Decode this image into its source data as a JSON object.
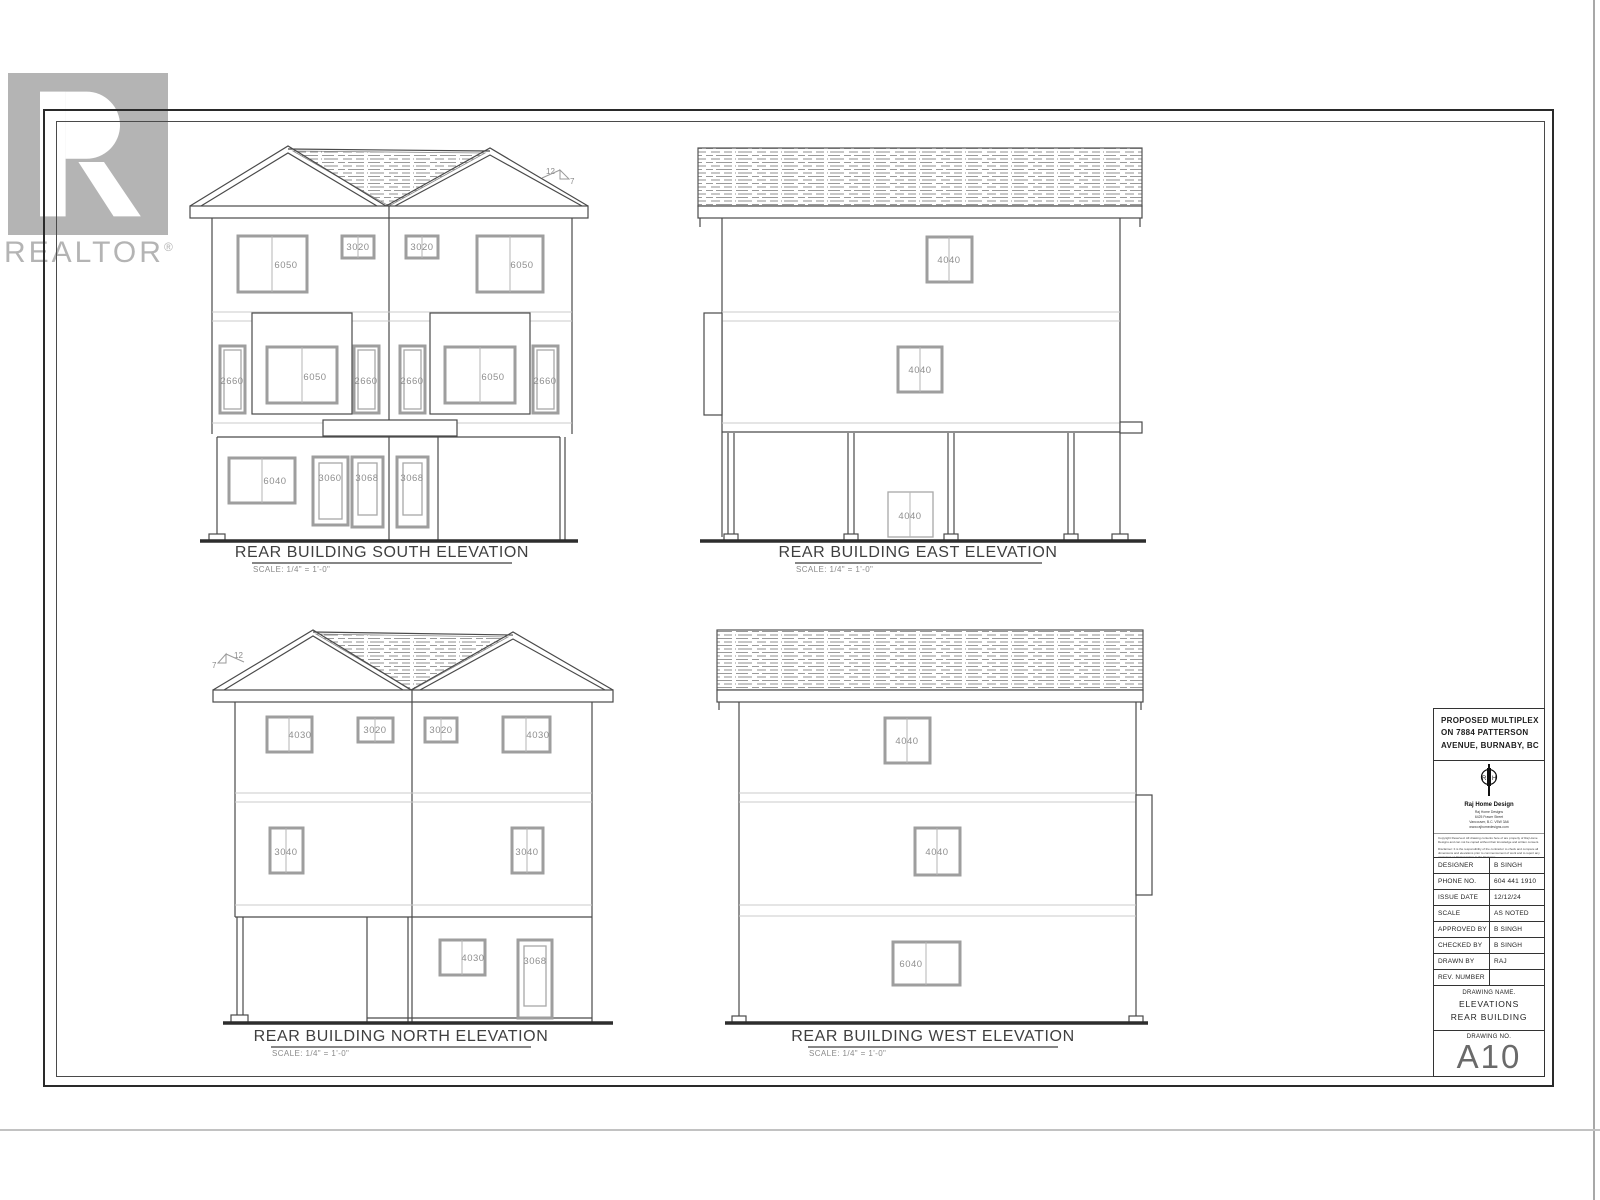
{
  "watermark": {
    "brand": "REALTOR",
    "registered": "®"
  },
  "colors": {
    "line": "#4a4a4a",
    "window_frame": "#9e9e9e",
    "watermark_gray": "#b4b4b4",
    "ground_line": "#2d2d2d"
  },
  "elevations": {
    "south": {
      "title": "REAR BUILDING SOUTH ELEVATION",
      "scale_note": "SCALE: 1/4\" = 1'-0\"",
      "pitch_rise": "12",
      "pitch_run": "7",
      "upper_windows": [
        "6050",
        "3020",
        "3020",
        "6050"
      ],
      "mid_windows": [
        "2660",
        "6050",
        "2660",
        "2660",
        "6050",
        "2660"
      ],
      "ground_windows": [
        "6040",
        "3060",
        "3068",
        "3068"
      ]
    },
    "east": {
      "title": "REAR BUILDING EAST ELEVATION",
      "scale_note": "SCALE: 1/4\" = 1'-0\"",
      "upper_windows": [
        "4040"
      ],
      "mid_windows": [
        "4040"
      ],
      "ground_windows": [
        "4040"
      ]
    },
    "north": {
      "title": "REAR BUILDING NORTH ELEVATION",
      "scale_note": "SCALE: 1/4\" = 1'-0\"",
      "pitch_rise": "12",
      "pitch_run": "7",
      "upper_windows": [
        "4030",
        "3020",
        "3020",
        "4030"
      ],
      "mid_windows": [
        "3040",
        "3040"
      ],
      "ground_windows": [
        "4030",
        "3068"
      ]
    },
    "west": {
      "title": "REAR BUILDING WEST ELEVATION",
      "scale_note": "SCALE: 1/4\" = 1'-0\"",
      "upper_windows": [
        "4040"
      ],
      "mid_windows": [
        "4040"
      ],
      "ground_windows": [
        "6040"
      ]
    }
  },
  "title_block": {
    "project_lines": [
      "PROPOSED MULTIPLEX",
      "ON 7884 PATTERSON",
      "AVENUE, BURNABY, BC"
    ],
    "company_name": "Raj Home Design",
    "company_info_lines": [
      "Raj Home Designs",
      "6425 Fraser Street",
      "Vancouver, B.C. V5W 3A6",
      "www.rajhomedesigns.com"
    ],
    "fine_print": [
      "Copyright Reserved. All drawing contents here of are property of Raj Home Designs and can not be copied without their knowledge and written consent.",
      "Disclaimer: It is the responsibility of the contractor to check and compare all dimensions and elevations prior to commencement of work and to report any omissions or discrepancies to the Designer."
    ],
    "fields": [
      {
        "label": "DESIGNER",
        "value": "B SINGH"
      },
      {
        "label": "PHONE NO.",
        "value": "604 441 1910"
      },
      {
        "label": "ISSUE DATE",
        "value": "12/12/24"
      },
      {
        "label": "SCALE",
        "value": "AS NOTED"
      },
      {
        "label": "APPROVED BY",
        "value": "B SINGH"
      },
      {
        "label": "CHECKED BY",
        "value": "B SINGH"
      },
      {
        "label": "DRAWN BY",
        "value": "RAJ"
      },
      {
        "label": "REV. NUMBER",
        "value": ""
      }
    ],
    "drawing_name_label": "DRAWING NAME.",
    "drawing_name_lines": [
      "ELEVATIONS",
      "REAR BUILDING"
    ],
    "drawing_no_label": "DRAWING NO.",
    "drawing_no": "A10"
  }
}
